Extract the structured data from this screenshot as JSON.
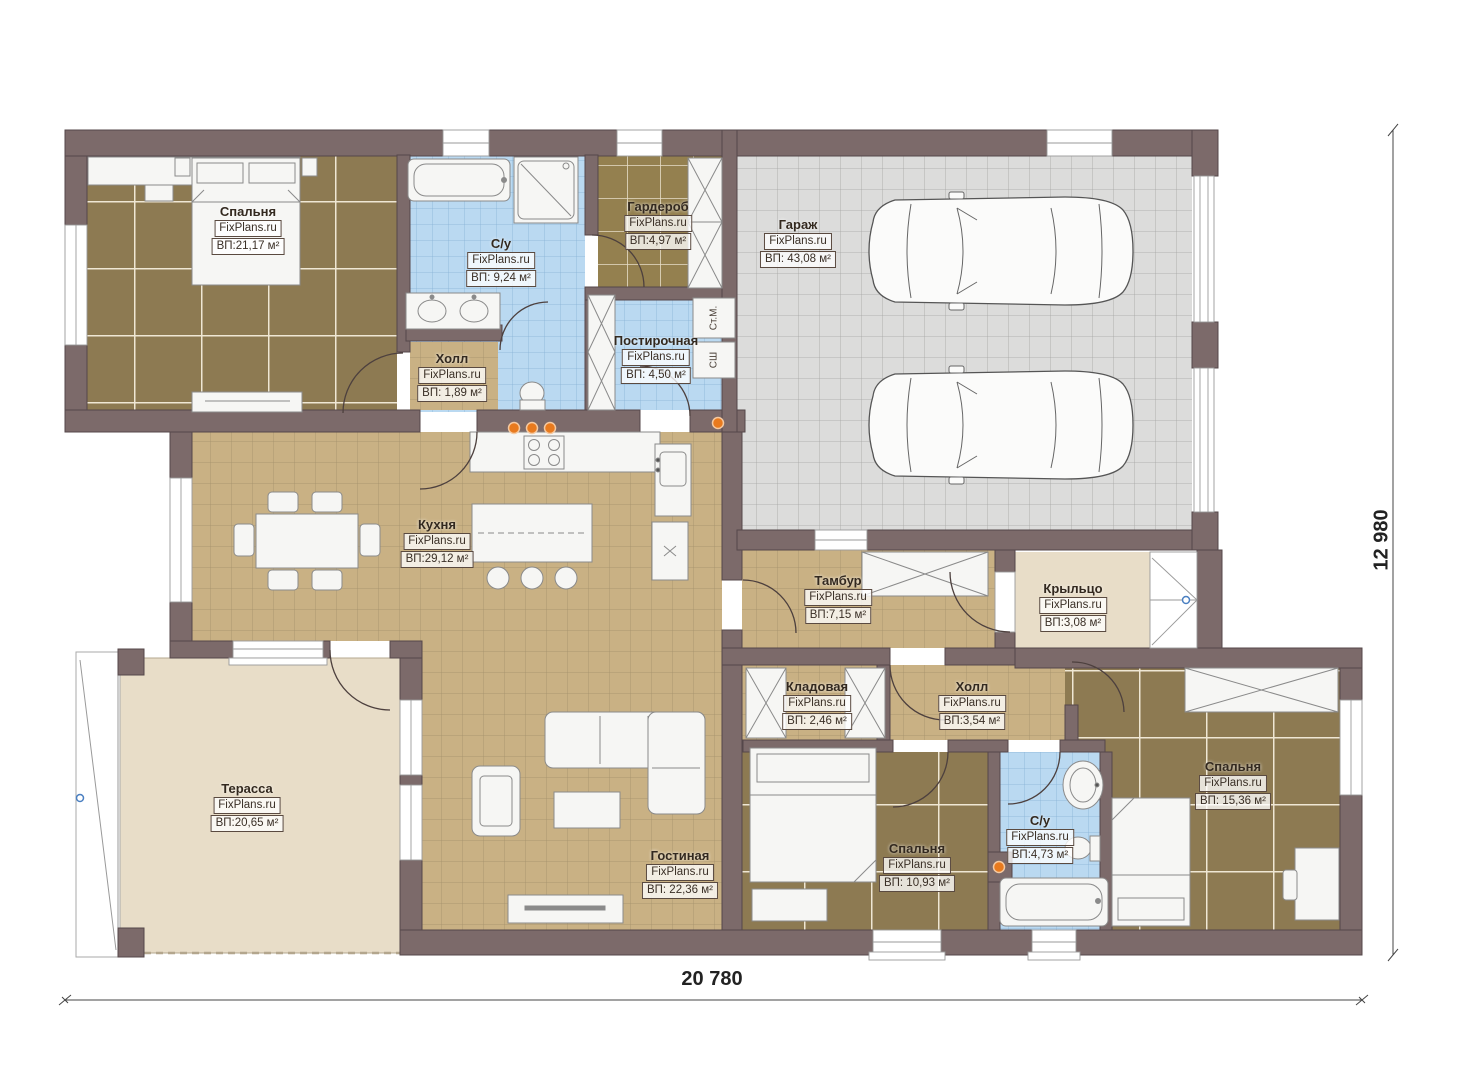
{
  "brand": "FixPlans.ru",
  "rooms": [
    {
      "name": "Спальня",
      "brand": "FixPlans.ru",
      "area": "ВП:21,17 м²"
    },
    {
      "name": "С/у",
      "brand": "FixPlans.ru",
      "area": "ВП: 9,24 м²"
    },
    {
      "name": "Гардероб",
      "brand": "FixPlans.ru",
      "area": "ВП:4,97 м²"
    },
    {
      "name": "Постирочная",
      "brand": "FixPlans.ru",
      "area": "ВП: 4,50 м²"
    },
    {
      "name": "Холл",
      "brand": "FixPlans.ru",
      "area": "ВП: 1,89 м²"
    },
    {
      "name": "Гараж",
      "brand": "FixPlans.ru",
      "area": "ВП: 43,08 м²"
    },
    {
      "name": "Кухня",
      "brand": "FixPlans.ru",
      "area": "ВП:29,12 м²"
    },
    {
      "name": "Тамбур",
      "brand": "FixPlans.ru",
      "area": "ВП:7,15 м²"
    },
    {
      "name": "Крыльцо",
      "brand": "FixPlans.ru",
      "area": "ВП:3,08 м²"
    },
    {
      "name": "Кладовая",
      "brand": "FixPlans.ru",
      "area": "ВП: 2,46 м²"
    },
    {
      "name": "Холл",
      "brand": "FixPlans.ru",
      "area": "ВП:3,54 м²"
    },
    {
      "name": "Терасса",
      "brand": "FixPlans.ru",
      "area": "ВП:20,65 м²"
    },
    {
      "name": "Гостиная",
      "brand": "FixPlans.ru",
      "area": "ВП: 22,36 м²"
    },
    {
      "name": "Спальня",
      "brand": "FixPlans.ru",
      "area": "ВП: 10,93 м²"
    },
    {
      "name": "С/у",
      "brand": "FixPlans.ru",
      "area": "ВП:4,73 м²"
    },
    {
      "name": "Спальня",
      "brand": "FixPlans.ru",
      "area": "ВП: 15,36 м²"
    }
  ],
  "appliances": {
    "washer": "Ст.М.",
    "dryer": "СШ"
  },
  "dimensions": {
    "width": "20 780",
    "height": "12 980"
  },
  "colors": {
    "wall": "#7c6a6a",
    "floor_wood": "#8d7a52",
    "floor_tan": "#c9b184",
    "floor_tile_blue": "#bad9f1",
    "floor_garage": "#dcdcdb",
    "floor_terrace": "#e8ddc8",
    "accent_orange": "#e87a1e",
    "marker_blue": "#4a7fc1"
  }
}
